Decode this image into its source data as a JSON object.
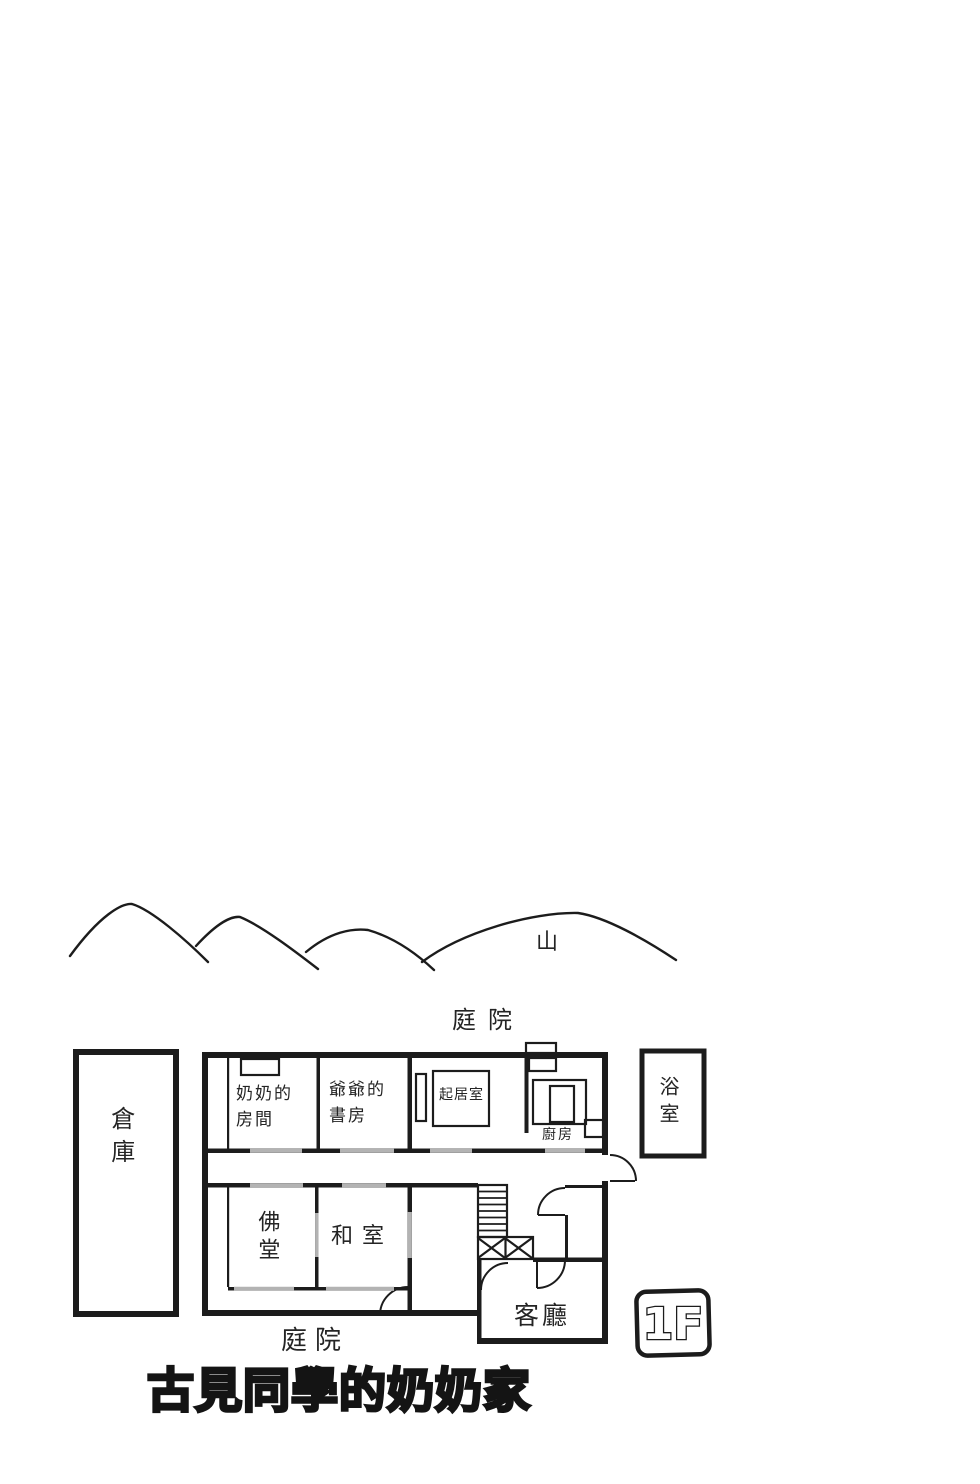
{
  "page": {
    "title": "古見同學的奶奶家",
    "floor_badge": "1F",
    "mountain_label": "山",
    "garden_label_top": "庭院",
    "garden_label_bottom": "庭院"
  },
  "rooms": {
    "storehouse": "倉庫",
    "grandma_room_line1": "奶奶的",
    "grandma_room_line2": "房間",
    "grandpa_study_line1": "爺爺的",
    "grandpa_study_line2": "書房",
    "living_room": "起居室",
    "kitchen": "廚房",
    "bath": "浴室",
    "altar_room": "佛堂",
    "tatami_room": "和室",
    "parlor": "客廳"
  },
  "colors": {
    "ink": "#1c1c1c",
    "paper": "#ffffff",
    "sliding_door_gray": "#b3b3b3"
  }
}
